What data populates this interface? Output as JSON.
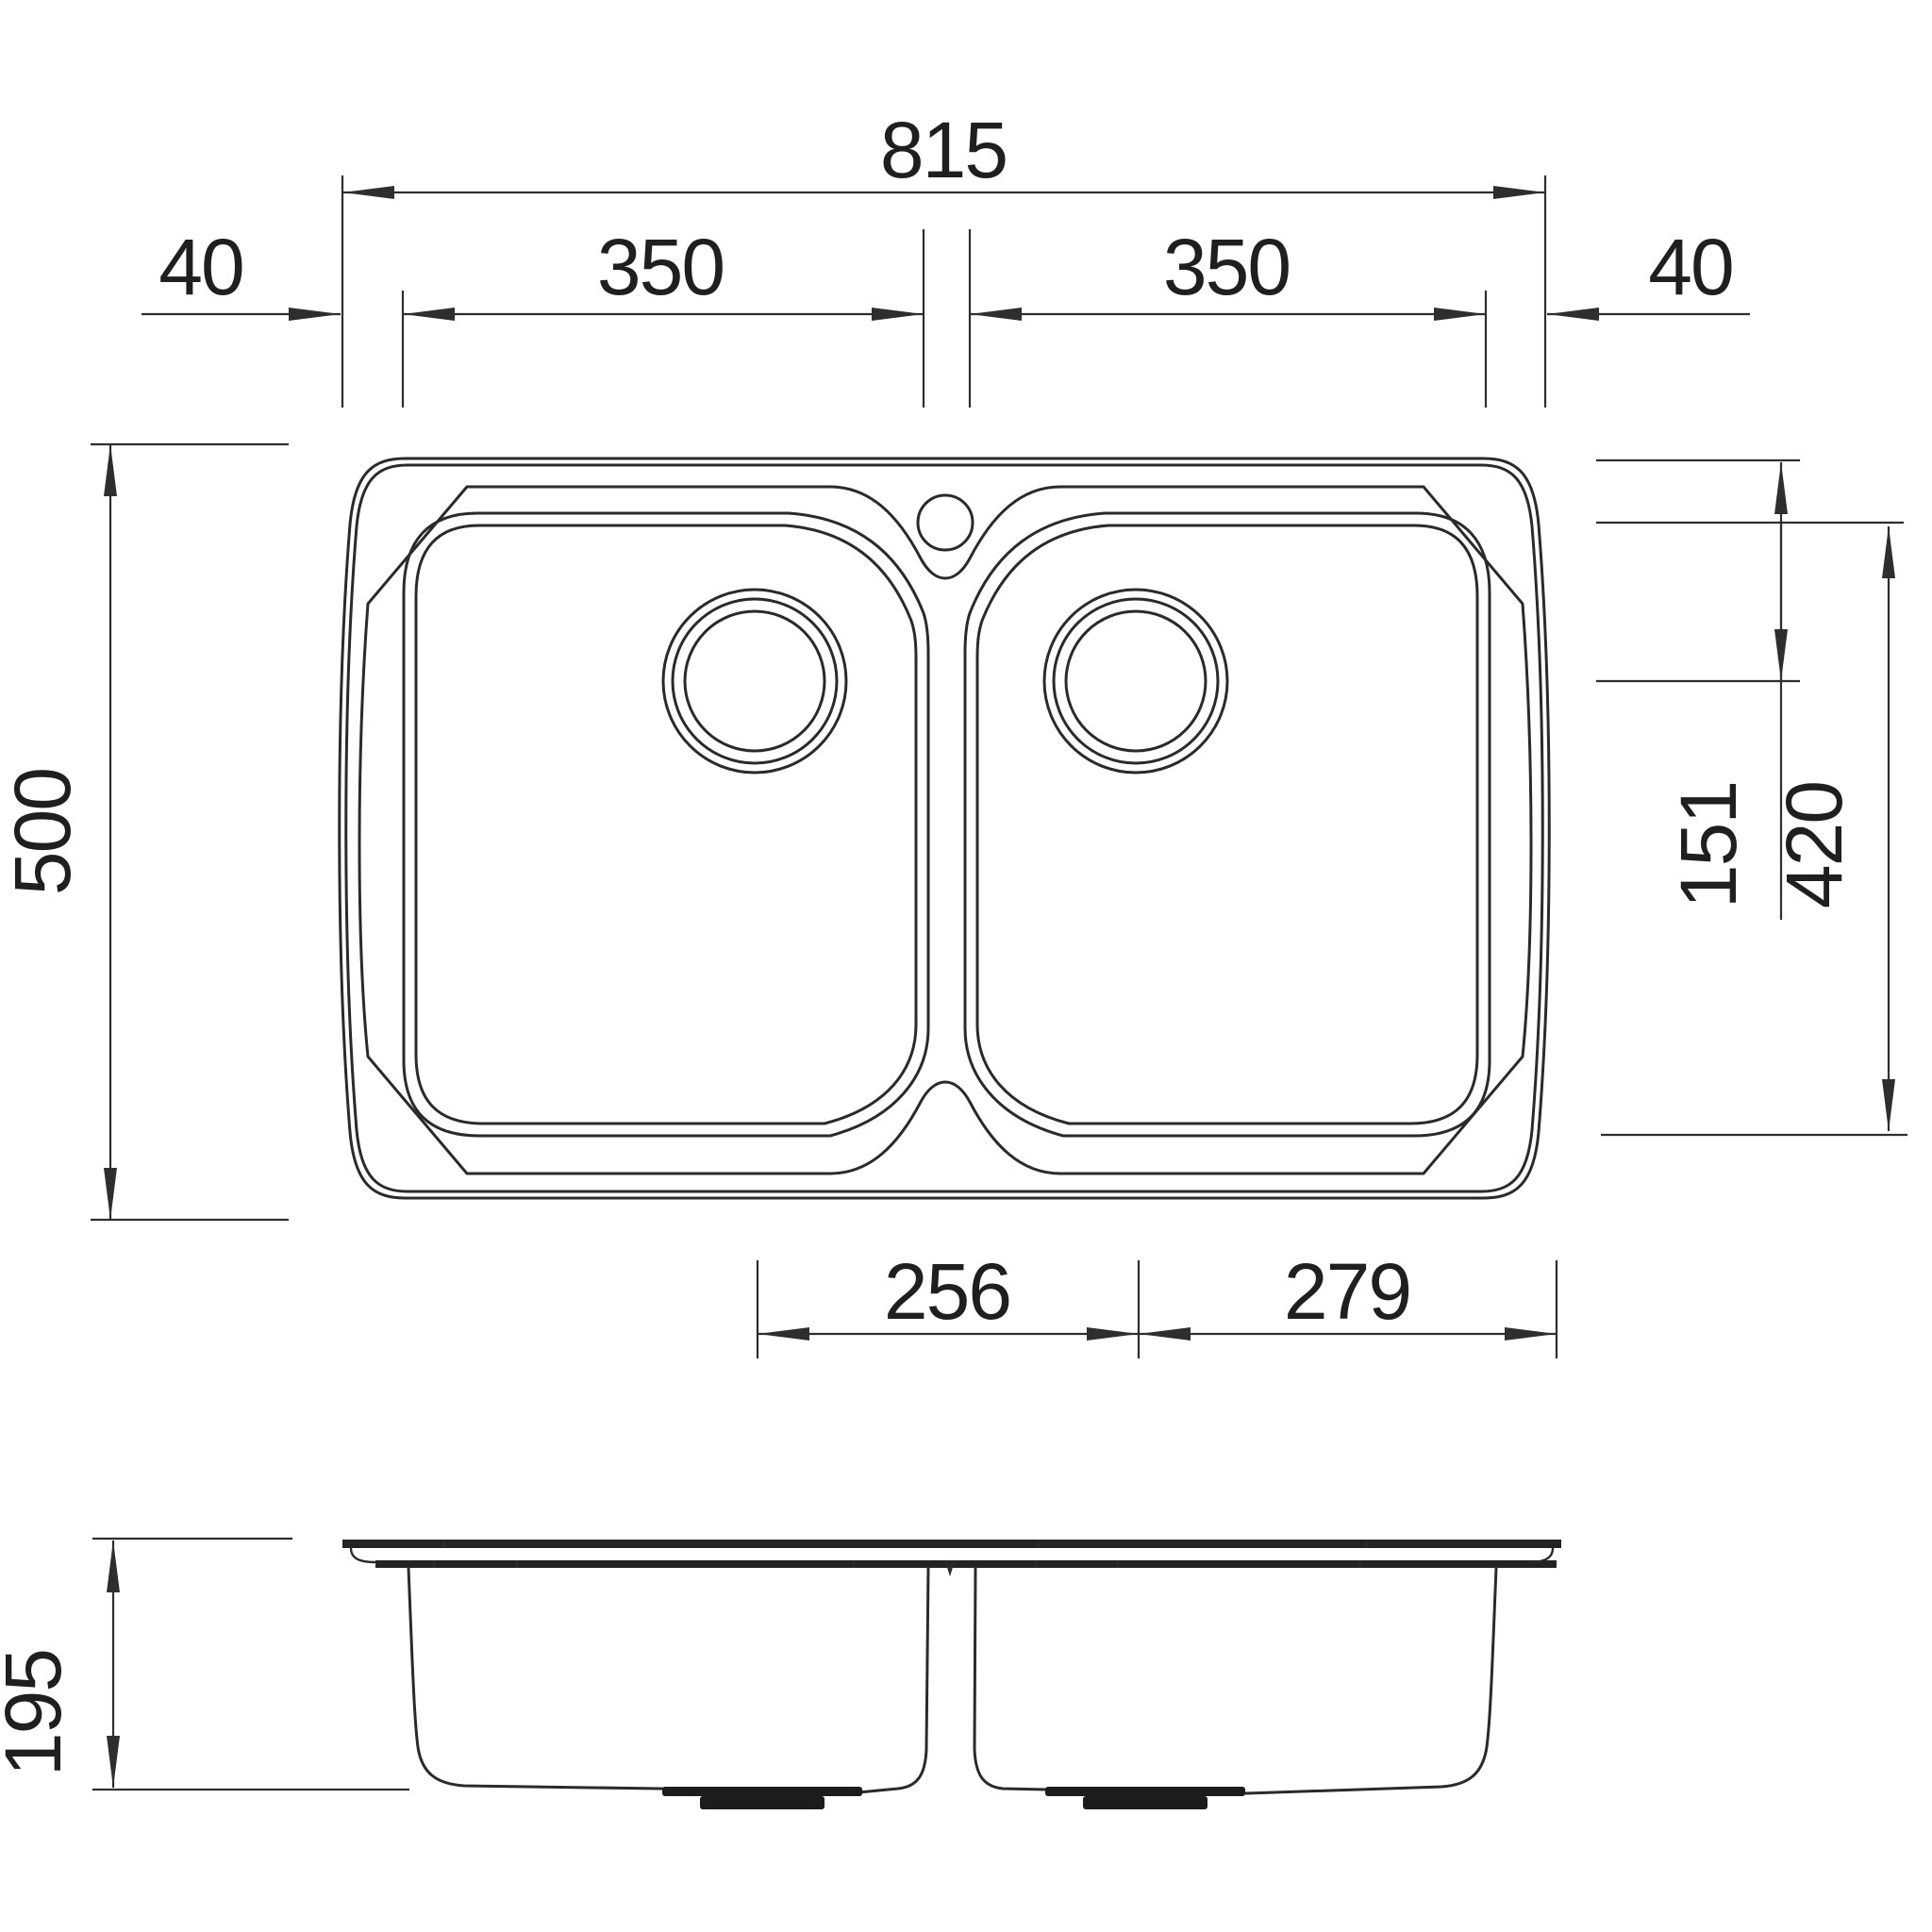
{
  "page": {
    "background": "#ffffff"
  },
  "drawing": {
    "type": "technical dimension drawing",
    "subject": "double bowl inset kitchen sink",
    "views": [
      {
        "id": "plan",
        "name": "top view"
      },
      {
        "id": "front",
        "name": "front elevation"
      }
    ],
    "units": "mm",
    "line_color": "#2a2a2a",
    "dim_color": "#2e2e2e",
    "text_color": "#1f1f1f"
  },
  "dims": {
    "overall_width": {
      "label": "815"
    },
    "left_bowl_width": {
      "label": "350"
    },
    "right_bowl_width": {
      "label": "350"
    },
    "left_rim": {
      "label": "40"
    },
    "right_rim": {
      "label": "40"
    },
    "overall_depth": {
      "label": "500"
    },
    "waste_centre_from_top": {
      "label": "151"
    },
    "bowl_inner_length": {
      "label": "420"
    },
    "waste_centre_spacing": {
      "label": "256"
    },
    "waste_centre_to_edge": {
      "label": "279"
    },
    "bowl_depth": {
      "label": "195"
    }
  }
}
